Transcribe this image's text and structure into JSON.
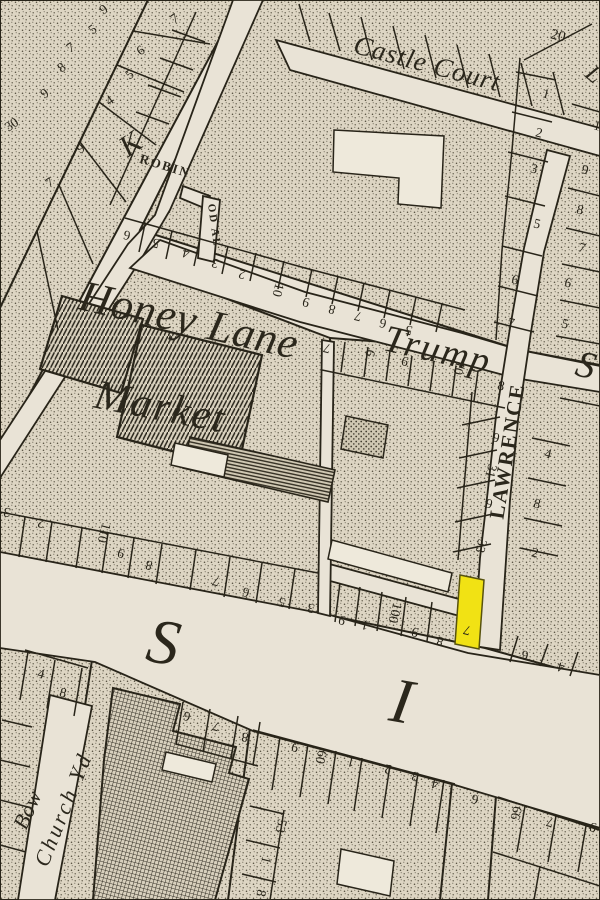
{
  "colors": {
    "paper": "#e9e3d6",
    "ink": "#282419",
    "block_base": "#ddd5c3"
  },
  "highlight": {
    "color": "#f1e214",
    "plot_number": "7"
  },
  "map": {
    "street_labels": [
      {
        "name": "label-castle-court",
        "text": "Castle Court",
        "x": 425,
        "y": 72,
        "r": 15,
        "s": 27,
        "cls": "it",
        "ls": 1
      },
      {
        "name": "label-honey-lane",
        "text": "Honey Lane",
        "x": 186,
        "y": 334,
        "r": 13,
        "s": 44,
        "cls": "it",
        "ls": 1
      },
      {
        "name": "label-market",
        "text": "Market",
        "x": 158,
        "y": 420,
        "r": 11,
        "s": 42,
        "cls": "it",
        "ls": 2
      },
      {
        "name": "label-trump-street",
        "text": "Trump",
        "x": 435,
        "y": 362,
        "r": 13,
        "s": 38,
        "cls": "it",
        "ls": 2
      },
      {
        "name": "label-trump-street-s",
        "text": "S",
        "x": 583,
        "y": 377,
        "r": 14,
        "s": 38,
        "cls": "it"
      },
      {
        "name": "label-lawrence-lane",
        "text": "LAWRENCE",
        "x": 514,
        "y": 452,
        "r": -81,
        "s": 21,
        "cls": "cap",
        "ls": 30
      },
      {
        "name": "label-milk-street-k",
        "text": "K",
        "x": 136,
        "y": 152,
        "r": -35,
        "s": 30,
        "cls": "it"
      },
      {
        "name": "label-robin-hood-alley",
        "text": "ROBIN",
        "x": 164,
        "y": 170,
        "r": 17,
        "s": 13,
        "cls": "cap",
        "ls": 2
      },
      {
        "name": "label-robin-hood-alley-2",
        "text": "OD AL",
        "x": 211,
        "y": 226,
        "r": 82,
        "s": 11,
        "cls": "cap",
        "ls": 2
      },
      {
        "name": "label-cheapside-s",
        "text": "S",
        "x": 160,
        "y": 663,
        "r": 10,
        "s": 64,
        "cls": "it"
      },
      {
        "name": "label-cheapside-i",
        "text": "I",
        "x": 398,
        "y": 722,
        "r": 10,
        "s": 64,
        "cls": "it"
      },
      {
        "name": "label-bow",
        "text": "Bow",
        "x": 34,
        "y": 813,
        "r": -66,
        "s": 22,
        "cls": "it"
      },
      {
        "name": "label-church-yd",
        "text": "Church Yd",
        "x": 70,
        "y": 812,
        "r": -68,
        "s": 22,
        "cls": "it",
        "ls": 3
      },
      {
        "name": "label-top-right-partial",
        "text": "L",
        "x": 589,
        "y": 80,
        "r": 40,
        "s": 24,
        "cls": "it"
      }
    ],
    "plot_numbers": [
      {
        "n": "9",
        "x": 106,
        "y": 13,
        "r": -35
      },
      {
        "n": "5",
        "x": 95,
        "y": 33,
        "r": -35
      },
      {
        "n": "7",
        "x": 73,
        "y": 51,
        "r": -35
      },
      {
        "n": "8",
        "x": 64,
        "y": 71,
        "r": -35
      },
      {
        "n": "9",
        "x": 47,
        "y": 97,
        "r": -35
      },
      {
        "n": "30",
        "x": 14,
        "y": 128,
        "r": -35
      },
      {
        "n": "7",
        "x": 177,
        "y": 22,
        "r": -35
      },
      {
        "n": "6",
        "x": 143,
        "y": 54,
        "r": -35
      },
      {
        "n": "5",
        "x": 132,
        "y": 78,
        "r": -35
      },
      {
        "n": "4",
        "x": 112,
        "y": 104,
        "r": -35
      },
      {
        "n": "9",
        "x": 83,
        "y": 152,
        "r": -35
      },
      {
        "n": "7",
        "x": 52,
        "y": 186,
        "r": -35
      },
      {
        "n": "6",
        "x": 128,
        "y": 231,
        "r": 194
      },
      {
        "n": "5",
        "x": 157,
        "y": 239,
        "r": 194
      },
      {
        "n": "4",
        "x": 187,
        "y": 249,
        "r": 194
      },
      {
        "n": "3",
        "x": 216,
        "y": 259,
        "r": 194
      },
      {
        "n": "2",
        "x": 243,
        "y": 270,
        "r": 194
      },
      {
        "n": "10",
        "x": 274,
        "y": 289,
        "r": 104
      },
      {
        "n": "9",
        "x": 307,
        "y": 298,
        "r": 194
      },
      {
        "n": "8",
        "x": 333,
        "y": 305,
        "r": 194
      },
      {
        "n": "7",
        "x": 359,
        "y": 312,
        "r": 194
      },
      {
        "n": "6",
        "x": 384,
        "y": 319,
        "r": 194
      },
      {
        "n": "5",
        "x": 410,
        "y": 326,
        "r": 194
      },
      {
        "n": "20",
        "x": 557,
        "y": 40,
        "r": 14,
        "s": 15
      },
      {
        "n": "1",
        "x": 545,
        "y": 98,
        "r": 14
      },
      {
        "n": "2",
        "x": 538,
        "y": 137,
        "r": 14
      },
      {
        "n": "3",
        "x": 533,
        "y": 173,
        "r": 14
      },
      {
        "n": "5",
        "x": 536,
        "y": 228,
        "r": 14
      },
      {
        "n": "6",
        "x": 514,
        "y": 284,
        "r": 14
      },
      {
        "n": "7",
        "x": 510,
        "y": 327,
        "r": 14
      },
      {
        "n": "1",
        "x": 596,
        "y": 130,
        "r": 14
      },
      {
        "n": "9",
        "x": 584,
        "y": 174,
        "r": 14
      },
      {
        "n": "8",
        "x": 579,
        "y": 214,
        "r": 14
      },
      {
        "n": "7",
        "x": 581,
        "y": 252,
        "r": 14
      },
      {
        "n": "6",
        "x": 567,
        "y": 287,
        "r": 14
      },
      {
        "n": "5",
        "x": 564,
        "y": 328,
        "r": 14
      },
      {
        "n": "7",
        "x": 328,
        "y": 344,
        "r": 194
      },
      {
        "n": "6",
        "x": 366,
        "y": 352,
        "r": 104
      },
      {
        "n": "9",
        "x": 406,
        "y": 357,
        "r": 194
      },
      {
        "n": "10",
        "x": 455,
        "y": 367,
        "r": 104
      },
      {
        "n": "8",
        "x": 500,
        "y": 390,
        "r": 14
      },
      {
        "n": "9",
        "x": 495,
        "y": 442,
        "r": 14
      },
      {
        "n": "31",
        "x": 487,
        "y": 470,
        "r": 104
      },
      {
        "n": "9",
        "x": 488,
        "y": 508,
        "r": 14
      },
      {
        "n": "33",
        "x": 477,
        "y": 545,
        "r": 104
      },
      {
        "n": "4",
        "x": 547,
        "y": 458,
        "r": 14
      },
      {
        "n": "8",
        "x": 536,
        "y": 508,
        "r": 14
      },
      {
        "n": "2",
        "x": 534,
        "y": 557,
        "r": 14
      },
      {
        "n": "3",
        "x": 8,
        "y": 508,
        "r": 194
      },
      {
        "n": "2",
        "x": 42,
        "y": 519,
        "r": 194
      },
      {
        "n": "110",
        "x": 100,
        "y": 532,
        "r": 104
      },
      {
        "n": "9",
        "x": 122,
        "y": 549,
        "r": 194
      },
      {
        "n": "8",
        "x": 150,
        "y": 561,
        "r": 194
      },
      {
        "n": "7",
        "x": 217,
        "y": 577,
        "r": 194
      },
      {
        "n": "6",
        "x": 247,
        "y": 588,
        "r": 194
      },
      {
        "n": "5",
        "x": 283,
        "y": 598,
        "r": 194
      },
      {
        "n": "3",
        "x": 312,
        "y": 604,
        "r": 194
      },
      {
        "n": "9",
        "x": 343,
        "y": 616,
        "r": 194
      },
      {
        "n": "1",
        "x": 366,
        "y": 621,
        "r": 194
      },
      {
        "n": "100",
        "x": 391,
        "y": 612,
        "r": 104
      },
      {
        "n": "9",
        "x": 416,
        "y": 628,
        "r": 194
      },
      {
        "n": "8",
        "x": 441,
        "y": 637,
        "r": 194
      },
      {
        "n": "7",
        "x": 468,
        "y": 626,
        "r": 194
      },
      {
        "n": "6",
        "x": 526,
        "y": 651,
        "r": 194
      },
      {
        "n": "4",
        "x": 562,
        "y": 663,
        "r": 194
      },
      {
        "n": "9",
        "x": 296,
        "y": 743,
        "r": 194
      },
      {
        "n": "60",
        "x": 317,
        "y": 756,
        "r": 104
      },
      {
        "n": "1",
        "x": 352,
        "y": 758,
        "r": 194
      },
      {
        "n": "2",
        "x": 389,
        "y": 765,
        "r": 194
      },
      {
        "n": "3",
        "x": 416,
        "y": 772,
        "r": 194
      },
      {
        "n": "4",
        "x": 436,
        "y": 780,
        "r": 194
      },
      {
        "n": "6",
        "x": 476,
        "y": 795,
        "r": 194
      },
      {
        "n": "66",
        "x": 512,
        "y": 812,
        "r": 104
      },
      {
        "n": "7",
        "x": 551,
        "y": 818,
        "r": 194
      },
      {
        "n": "9",
        "x": 594,
        "y": 823,
        "r": 194
      },
      {
        "n": "53",
        "x": 277,
        "y": 825,
        "r": 104
      },
      {
        "n": "1",
        "x": 262,
        "y": 859,
        "r": 104
      },
      {
        "n": "8",
        "x": 257,
        "y": 892,
        "r": 104
      },
      {
        "n": "6",
        "x": 188,
        "y": 712,
        "r": 194
      },
      {
        "n": "7",
        "x": 217,
        "y": 722,
        "r": 194
      },
      {
        "n": "8",
        "x": 246,
        "y": 733,
        "r": 194
      },
      {
        "n": "4",
        "x": 40,
        "y": 678,
        "r": 14
      },
      {
        "n": "8",
        "x": 62,
        "y": 697,
        "r": 14
      }
    ]
  }
}
